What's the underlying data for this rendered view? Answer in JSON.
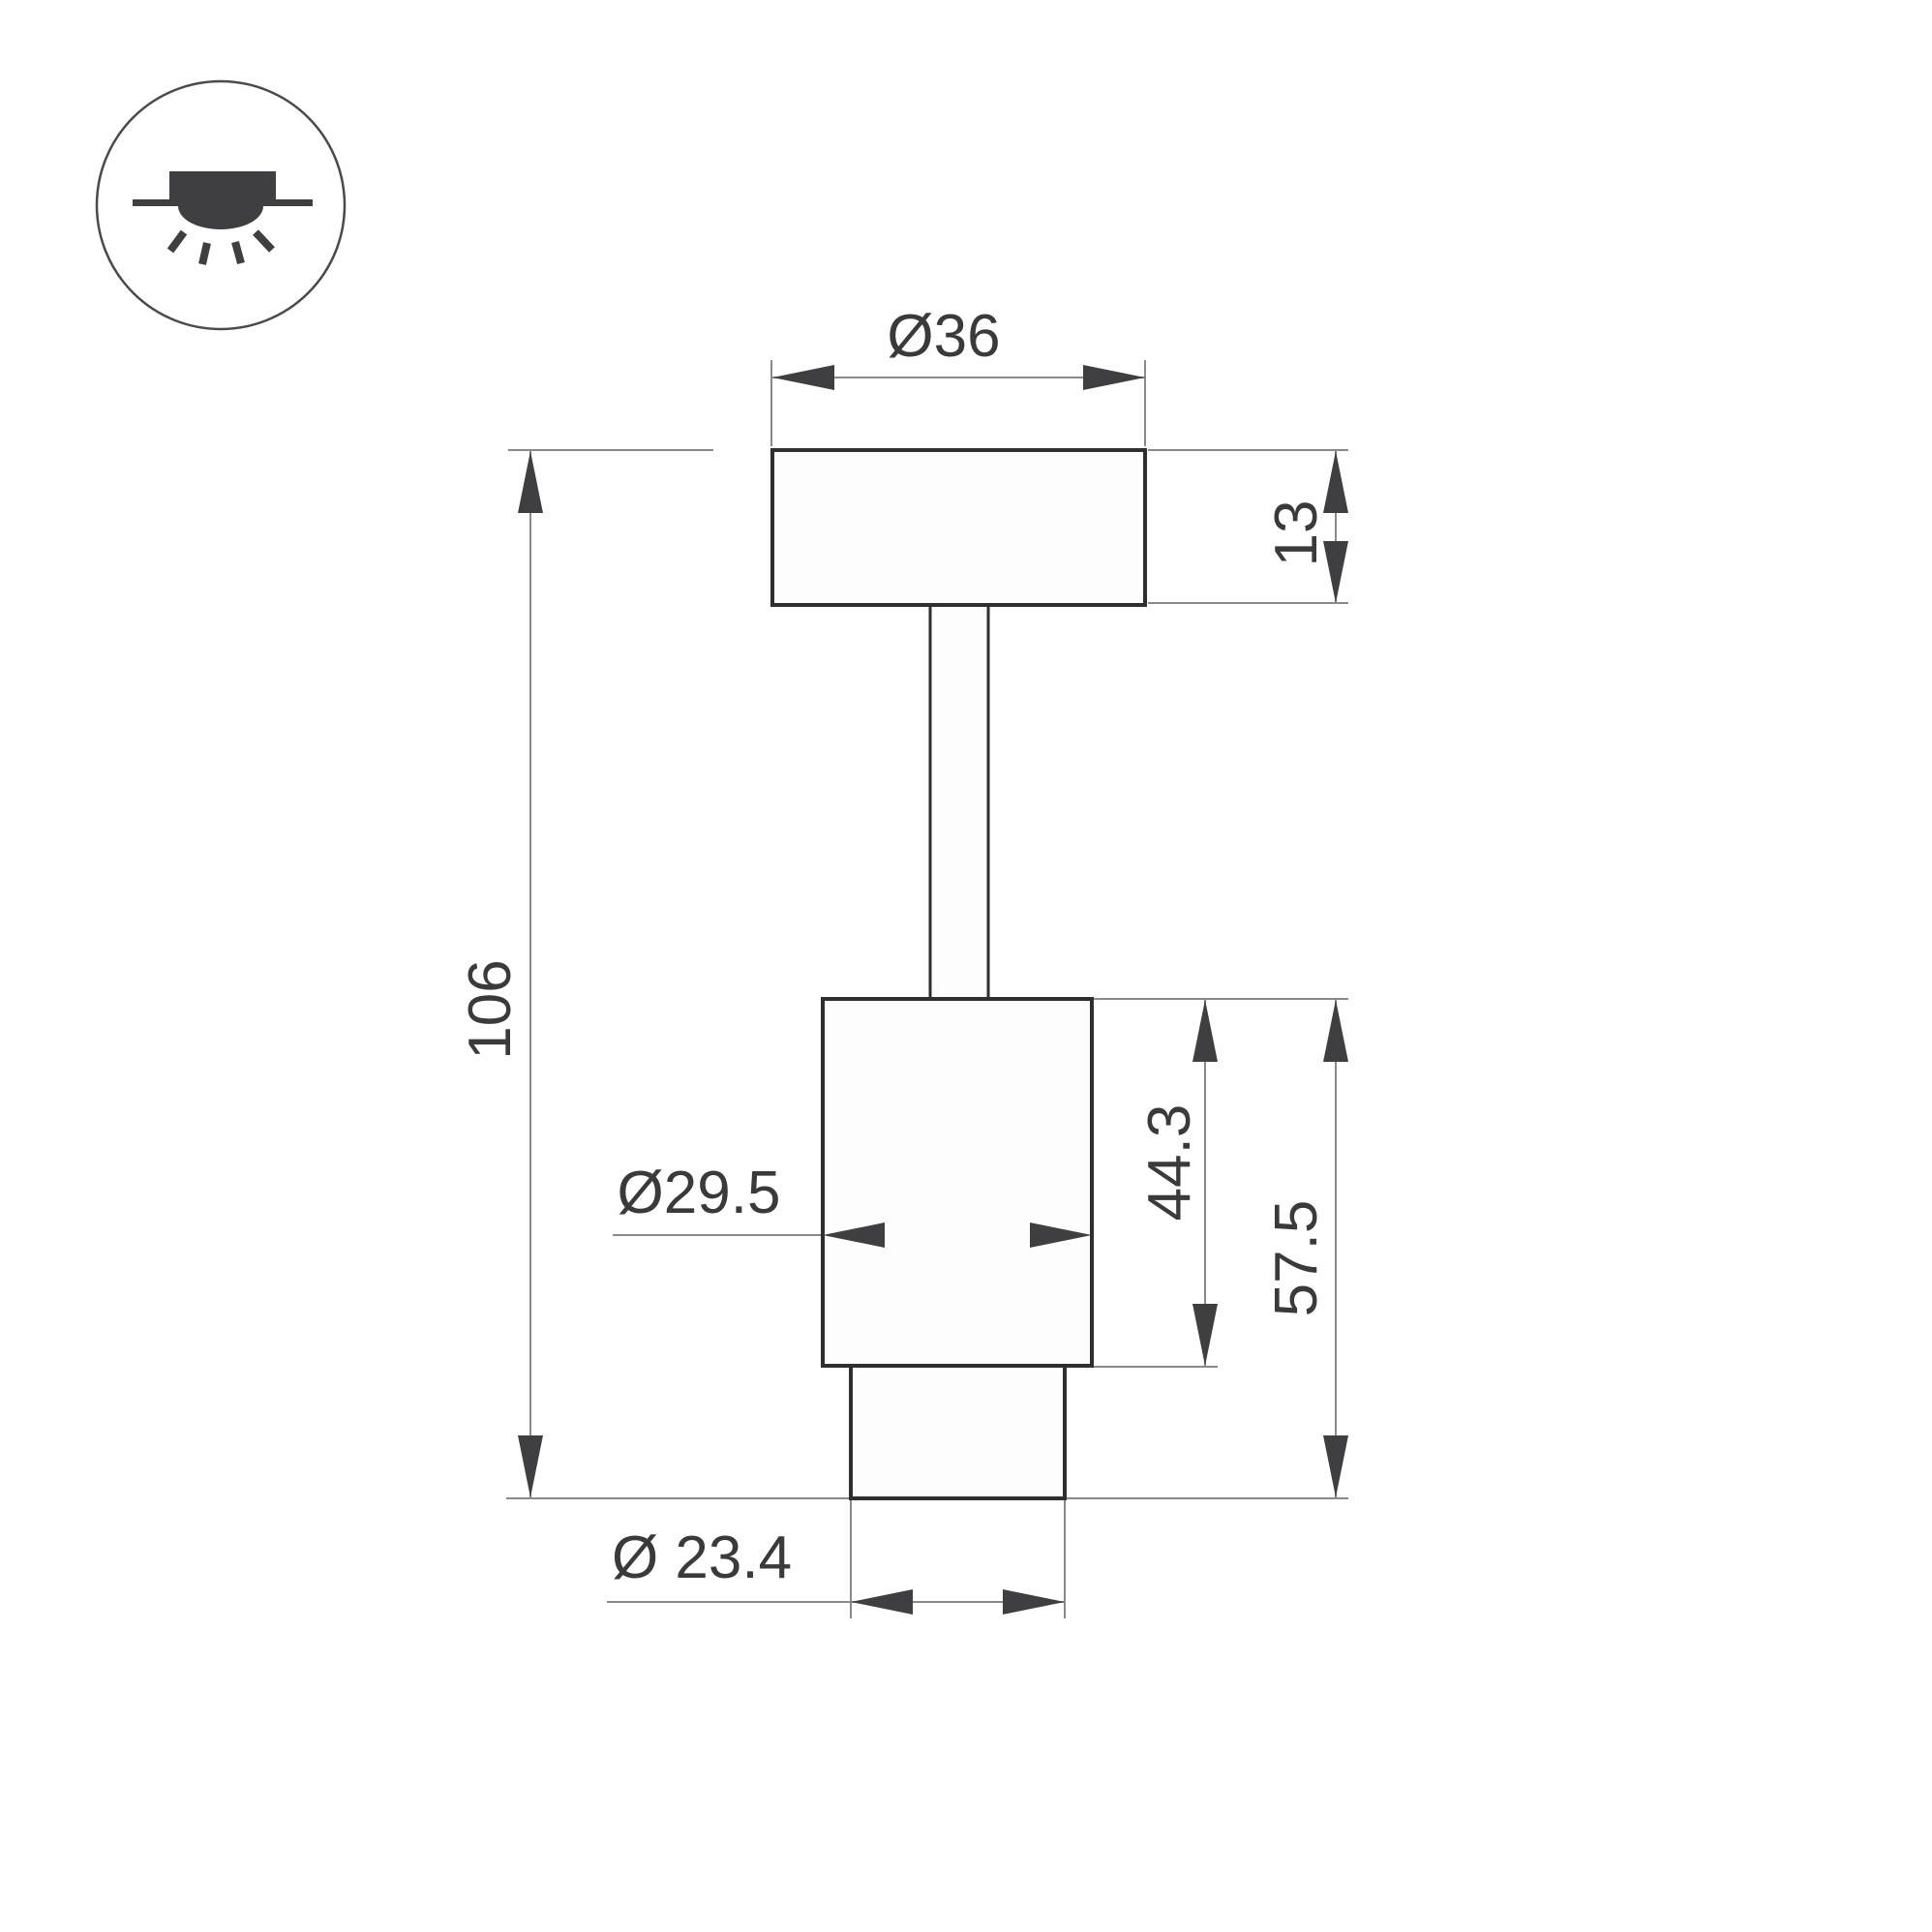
{
  "drawing_type": "technical dimension drawing of surface-mounted spot luminaire",
  "icon": {
    "meaning": "surface-mounted downlight symbol"
  },
  "dims": {
    "top_diameter": "Ø36",
    "cap_height": "13",
    "overall_height": "106",
    "body_diameter": "Ø29.5",
    "body_height": "44.3",
    "lower_height": "57.5",
    "bottom_diameter": "Ø 23.4"
  },
  "colors": {
    "background": "#fefefe",
    "object_line": "#2f2f31",
    "dimension_line": "#8a8a8a",
    "arrow_and_text": "#3a3a3c",
    "icon": "#3f3f42"
  }
}
